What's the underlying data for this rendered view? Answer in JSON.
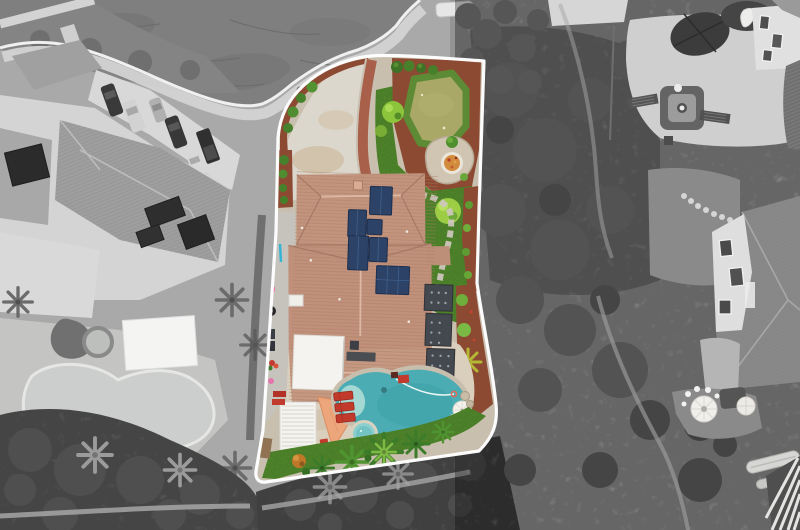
{
  "scene": {
    "type": "aerial-drone-photo",
    "subject": "residential property highlighted in color within desaturated neighborhood",
    "style": "grayscale surroundings, full-color subject lot, white lot boundary outline"
  },
  "palette": {
    "boundary_line": "#ffffff",
    "curb": "#f0f0f0",
    "street_asphalt": "#7f7f7f",
    "sidewalk": "#d3d3d3",
    "gray_ground": "#a9a9a9",
    "scrub_base": "#949494",
    "scrub_dark": "#5a5a5a",
    "neighbor_roof": "#9e9e9e",
    "neighbor_wall": "#d4d4d4",
    "neighbor_pool_water": "#cbcecc",
    "vehicle_dark": "#3a3a3a",
    "vehicle_light": "#d6d6d6",
    "driveway_concrete": "#dcd7cd",
    "dirt_patch": "#cdbc9e",
    "mulch_red": "#8d4a33",
    "mulch_path": "#a8604a",
    "lawn_green": "#5e9e33",
    "putting_green": "#aaa866",
    "green_fringe": "#5d8a35",
    "tree_bright": "#8cc43c",
    "tree_dark": "#3c7b2a",
    "roof_tile": "#c3947d",
    "roof_ridge": "#e3c2ae",
    "solar_panel": "#2c4266",
    "shed_dark": "#44484f",
    "white_structure": "#f4f3ef",
    "shade_sail": "#eda57c",
    "lounger_red": "#c23a2c",
    "pool_water": "#4badb3",
    "pool_shallow": "#a9dad5",
    "spa_water": "#8ccfce",
    "deck_tan": "#dacfbc",
    "stone_path": "#ccc6ba",
    "firepit_glass": "#d28a3c",
    "umbrella_white": "#f4f2ec"
  },
  "property_features": [
    "tile-roof-house",
    "solar-panels",
    "curved-driveway",
    "putting-green",
    "fire-pit",
    "backyard-lawn",
    "garden-path",
    "white-patio-cover",
    "slatted-pergola",
    "shade-sail",
    "swimming-pool",
    "spa",
    "pool-deck",
    "red-loungers",
    "patio-umbrella",
    "storage-sheds",
    "palm-trees",
    "red-mulch-beds",
    "hedge-row",
    "side-yard-storage"
  ],
  "surroundings": [
    "cul-de-sac-street",
    "sidewalk",
    "left-neighbor-house",
    "parked-cars",
    "neighbor-pool",
    "neighbor-patio-cover",
    "gravel-patio",
    "dark-patio-umbrellas",
    "fire-pit-seating",
    "right-neighbor-houses",
    "white-gazebo",
    "boats",
    "corner-pergola",
    "scrubland",
    "dirt-trails",
    "rv-trailer"
  ]
}
